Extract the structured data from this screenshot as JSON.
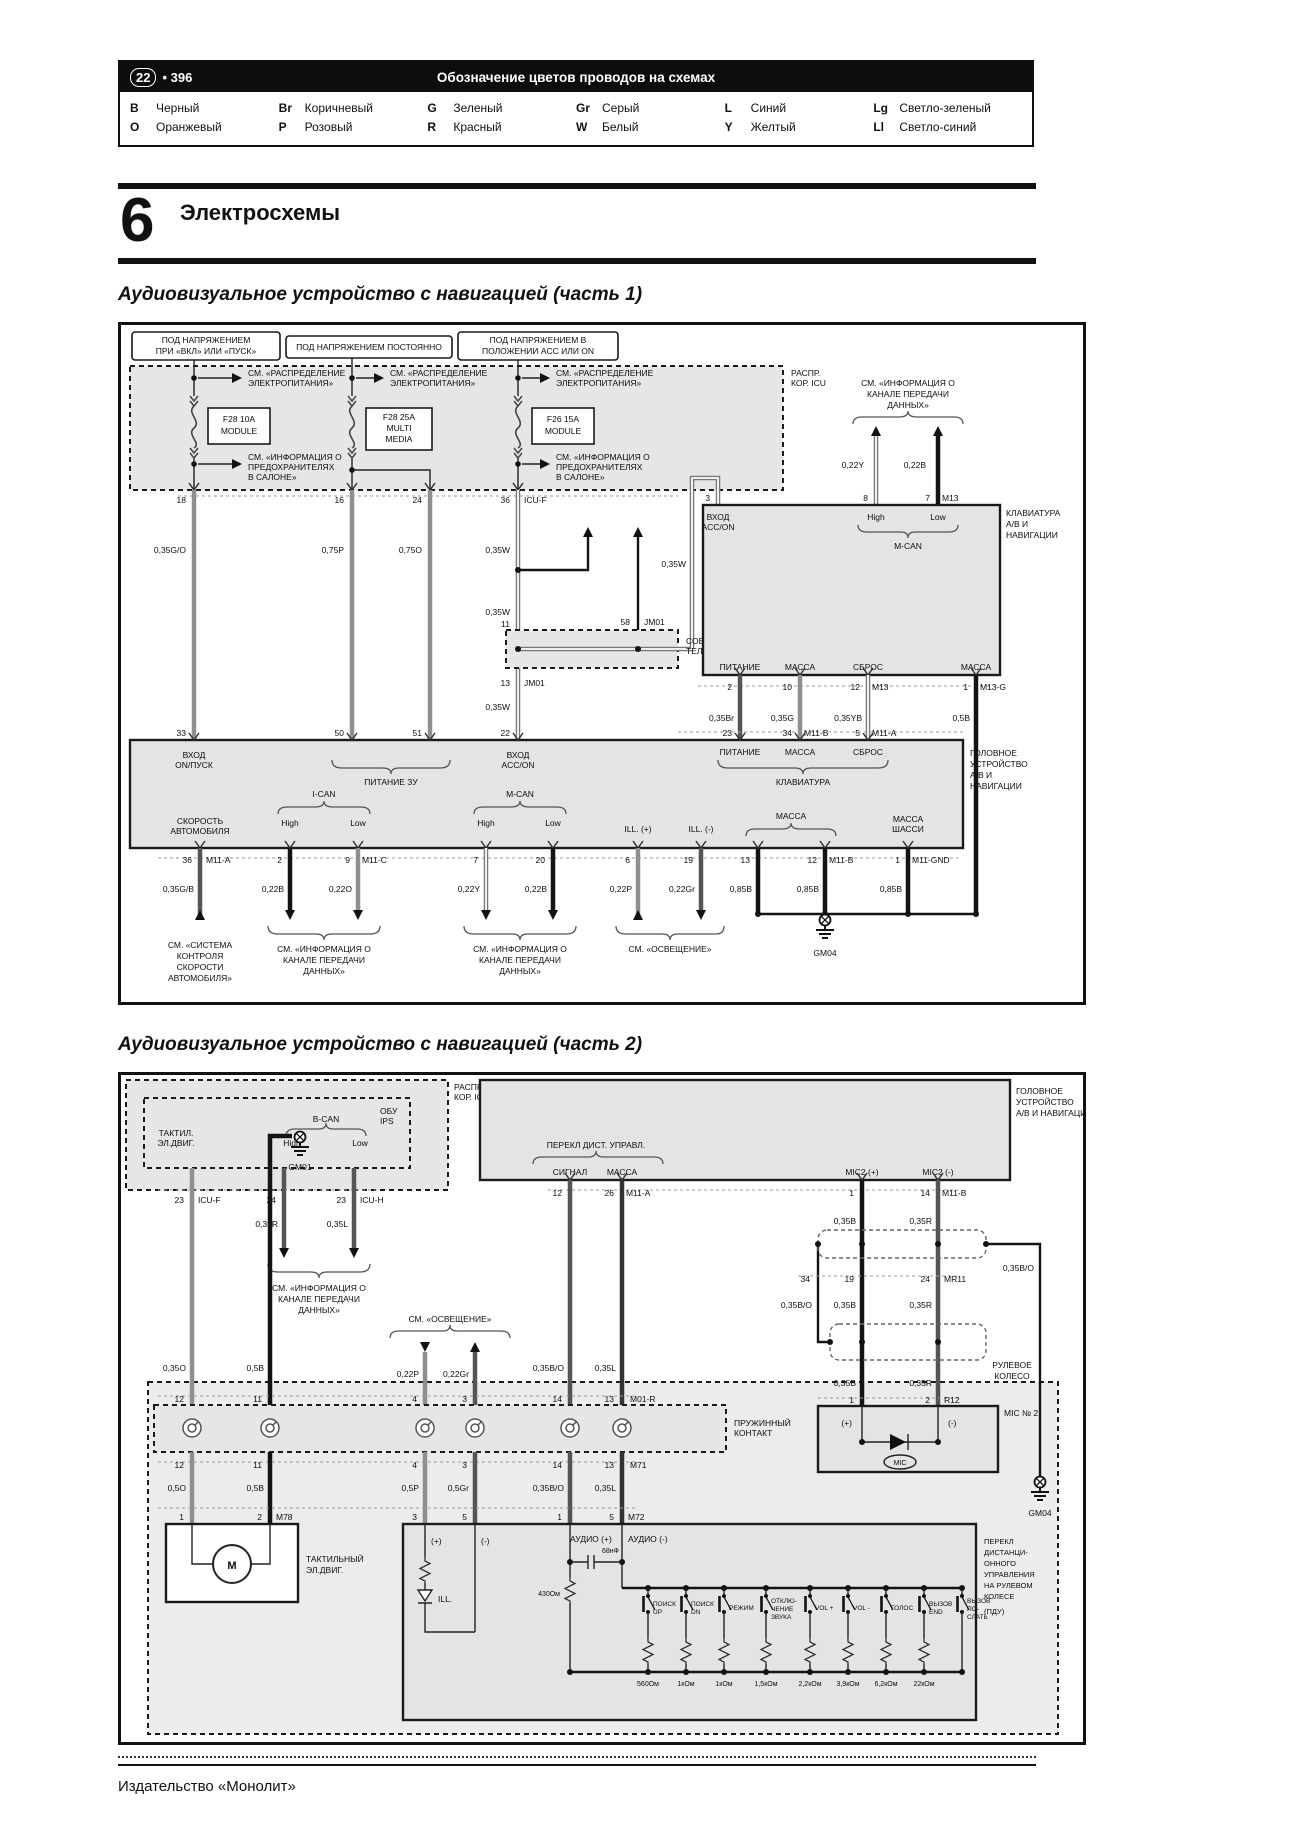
{
  "header": {
    "page_badge": "22",
    "page_num": "• 396",
    "title": "Обозначение цветов проводов на схемах",
    "legend_rows": [
      [
        [
          "B",
          "Черный"
        ],
        [
          "Br",
          "Коричневый"
        ],
        [
          "G",
          "Зеленый"
        ],
        [
          "Gr",
          "Серый"
        ],
        [
          "L",
          "Синий"
        ],
        [
          "Lg",
          "Светло-зеленый"
        ]
      ],
      [
        [
          "O",
          "Оранжевый"
        ],
        [
          "P",
          "Розовый"
        ],
        [
          "R",
          "Красный"
        ],
        [
          "W",
          "Белый"
        ],
        [
          "Y",
          "Желтый"
        ],
        [
          "Ll",
          "Светло-синий"
        ]
      ]
    ]
  },
  "section": {
    "number": "6",
    "title": "Электросхемы"
  },
  "footer": {
    "publisher": "Издательство «Монолит»"
  },
  "common": {
    "see_power_1": "СМ. «РАСПРЕДЕЛЕНИЕ",
    "see_power_2": "ЭЛЕКТРОПИТАНИЯ»",
    "see_fuse_1": "СМ. «ИНФОРМАЦИЯ О",
    "see_fuse_2": "ПРЕДОХРАНИТЕЛЯХ",
    "see_fuse_3": "В САЛОНЕ»",
    "info_1": "СМ. «ИНФОРМАЦИЯ О",
    "info_2": "КАНАЛЕ ПЕРЕДАЧИ",
    "info_3": "ДАННЫХ»",
    "see_light": "СМ. «ОСВЕЩЕНИЕ»",
    "high": "High",
    "low": "Low"
  },
  "d1": {
    "title": "Аудиовизуальное устройство с навигацией (часть 1)",
    "corner_1": "РАСПР.",
    "corner_2": "КОР. ICU",
    "pb1_1": "ПОД НАПРЯЖЕНИЕМ",
    "pb1_2": "ПРИ «ВКЛ» ИЛИ «ПУСК»",
    "pb2": "ПОД НАПРЯЖЕНИЕМ ПОСТОЯННО",
    "pb3_1": "ПОД НАПРЯЖЕНИЕМ В",
    "pb3_2": "ПОЛОЖЕНИИ ACC ИЛИ ON",
    "fuse1_1": "F28 10A",
    "fuse1_2": "MODULE",
    "fuse2_1": "F28 25A",
    "fuse2_2": "MULTI",
    "fuse2_3": "MEDIA",
    "fuse3_1": "F26 15A",
    "fuse3_2": "MODULE",
    "pin18": "18",
    "pin16": "16",
    "pin24": "24",
    "pin36": "36",
    "icu_f": "ICU-F",
    "w_035go": "0,35G/O",
    "w_075p": "0,75P",
    "w_075o": "0,75O",
    "w_035w": "0,35W",
    "pin11": "11",
    "pin13": "13",
    "pin58": "58",
    "jm01": "JM01",
    "conn_1": "СОЕДИНИ-",
    "conn_2": "ТЕЛЬ",
    "pin33": "33",
    "pin50": "50",
    "pin51": "51",
    "pin22": "22",
    "vhod": "ВХОД",
    "on_pusk": "ОN/ПУСК",
    "acc_on": "ACC/ON",
    "pit_zu": "ПИТАНИЕ ЗУ",
    "pin3": "3",
    "pin8": "8",
    "pin7": "7",
    "m13": "M13",
    "w_022y": "0,22Y",
    "w_022b": "0,22B",
    "m_can": "M-CAN",
    "i_can": "I-CAN",
    "kb_1": "КЛАВИАТУРА",
    "kb_2": "А/В И",
    "kb_3": "НАВИГАЦИИ",
    "pitanie": "ПИТАНИЕ",
    "massa": "МАССА",
    "sbros": "СБРОС",
    "pin2": "2",
    "pin10": "10",
    "pin12": "12",
    "pin1": "1",
    "m13_g": "M13-G",
    "w_035br": "0,35Br",
    "w_035g": "0,35G",
    "w_035yb": "0,35YB",
    "w_05b": "0,5B",
    "pin23": "23",
    "pin34": "34",
    "m11_b": "M11-B",
    "pin5": "5",
    "m11_a": "M11-A",
    "klaviatura": "КЛАВИАТУРА",
    "hu_1": "ГОЛОВНОЕ",
    "hu_2": "УСТРОЙСТВО",
    "hu_3": "А/В И",
    "hu_4": "НАВИГАЦИИ",
    "speed_1": "СКОРОСТЬ",
    "speed_2": "АВТОМОБИЛЯ",
    "pin36b": "36",
    "pin2b": "2",
    "pin9": "9",
    "m11_c": "M11-C",
    "pin7b": "7",
    "pin20": "20",
    "pin6": "6",
    "pin19": "19",
    "pin13b": "13",
    "pin12b": "12",
    "pin1b": "1",
    "m11_gnd": "M11-GND",
    "w_035gb": "0,35G/B",
    "w_022o": "0,22O",
    "w_022p": "0,22P",
    "w_022gr": "0,22Gr",
    "w_085b": "0,85B",
    "ill_p": "ILL. (+)",
    "ill_m": "ILL. (-)",
    "shassi": "ШАССИ",
    "see_speed_1": "СМ. «СИСТЕМА",
    "see_speed_2": "КОНТРОЛЯ",
    "see_speed_3": "СКОРОСТИ",
    "see_speed_4": "АВТОМОБИЛЯ»",
    "gm04": "GM04"
  },
  "d2": {
    "title": "Аудиовизуальное устройство с навигацией (часть 2)",
    "corner_1": "РАСПР.",
    "corner_2": "КОР. ICU",
    "obu_1": "ОБУ",
    "obu_2": "IPS",
    "taktil_1": "ТАКТИЛ.",
    "taktil_2": "ЭЛ.ДВИГ.",
    "b_can": "B-CAN",
    "pin23": "23",
    "icu_f": "ICU-F",
    "pin24": "24",
    "pin23b": "23",
    "icu_h": "ICU-H",
    "w_035r": "0,35R",
    "w_035l": "0,35L",
    "w_035o": "0,35O",
    "w_05b": "0,5B",
    "gm01": "GM01",
    "hu_1": "ГОЛОВНОЕ",
    "hu_2": "УСТРОЙСТВО",
    "hu_3": "А/В И НАВИГАЦИИ",
    "perekl_remote": "ПЕРЕКЛ ДИСТ. УПРАВЛ.",
    "signal": "СИГНАЛ",
    "massa": "МАССА",
    "pin12": "12",
    "pin26": "26",
    "m11_a": "M11-A",
    "mic2_p": "MIC2 (+)",
    "mic2_m": "MIC2 (-)",
    "pin1": "1",
    "pin14": "14",
    "m11_b": "M11-B",
    "w_035b": "0,35B",
    "w_035bo": "0,35B/O",
    "pin34": "34",
    "pin19": "19",
    "pin24b": "24",
    "mr11": "MR11",
    "pin1b": "1",
    "pin2": "2",
    "r12": "R12",
    "mic_box": "MIC № 2",
    "plus": "(+)",
    "minus": "(-)",
    "mic": "MIC",
    "gm04": "GM04",
    "spring_1": "ПРУЖИННЫЙ",
    "spring_2": "КОНТАКТ",
    "m01_r": "M01-R",
    "m71": "M71",
    "pin12b": "12",
    "pin11": "11",
    "pin4": "4",
    "pin3": "3",
    "pin14b": "14",
    "pin13": "13",
    "w_022p": "0,22P",
    "w_022gr": "0,22Gr",
    "w_05o": "0,5O",
    "w_05p": "0,5P",
    "w_05gr": "0,5Gr",
    "pin1c": "1",
    "pin2b": "2",
    "m78": "M78",
    "pin3b": "3",
    "pin5": "5",
    "pin1d": "1",
    "pin5b": "5",
    "m72": "M72",
    "rul_1": "РУЛЕВОЕ",
    "rul_2": "КОЛЕСО",
    "takt_1": "ТАКТИЛЬНЫЙ",
    "takt_2": "ЭЛ.ДВИГ.",
    "motor": "M",
    "ill": "ILL.",
    "audio_p": "АУДИО (+)",
    "audio_m": "АУДИО (-)",
    "cap": "68нФ",
    "r430": "430Ом",
    "sw1_1": "ПОИСК",
    "sw1_2": "UP",
    "sw2_1": "ПОИСК",
    "sw2_2": "DN",
    "sw3_1": "РЕЖИМ",
    "sw4_1": "ОТКЛЮ-",
    "sw4_2": "ЧЕНИЕ",
    "sw4_3": "ЗВУКА",
    "sw5_1": "VOL +",
    "sw6_1": "VOL -",
    "sw7_1": "ГОЛОС",
    "sw8_1": "ВЫЗОВ",
    "sw8_2": "END",
    "sw9_1": "ВЫЗОВ",
    "sw9_2": "ПО-",
    "sw9_3": "СЛАТЬ",
    "r1": "560Ом",
    "r2": "1кОм",
    "r3": "1кОм",
    "r4": "1,5кОм",
    "r5": "2,2кОм",
    "r6": "3,9кОм",
    "r7": "6,2кОм",
    "r8": "22кОм",
    "pdu_1": "ПЕРЕКЛ",
    "pdu_2": "ДИСТАНЦИ-",
    "pdu_3": "ОННОГО",
    "pdu_4": "УПРАВЛЕНИЯ",
    "pdu_5": "НА РУЛЕВОМ",
    "pdu_6": "КОЛЕСЕ",
    "pdu_7": "(ПДУ)"
  }
}
